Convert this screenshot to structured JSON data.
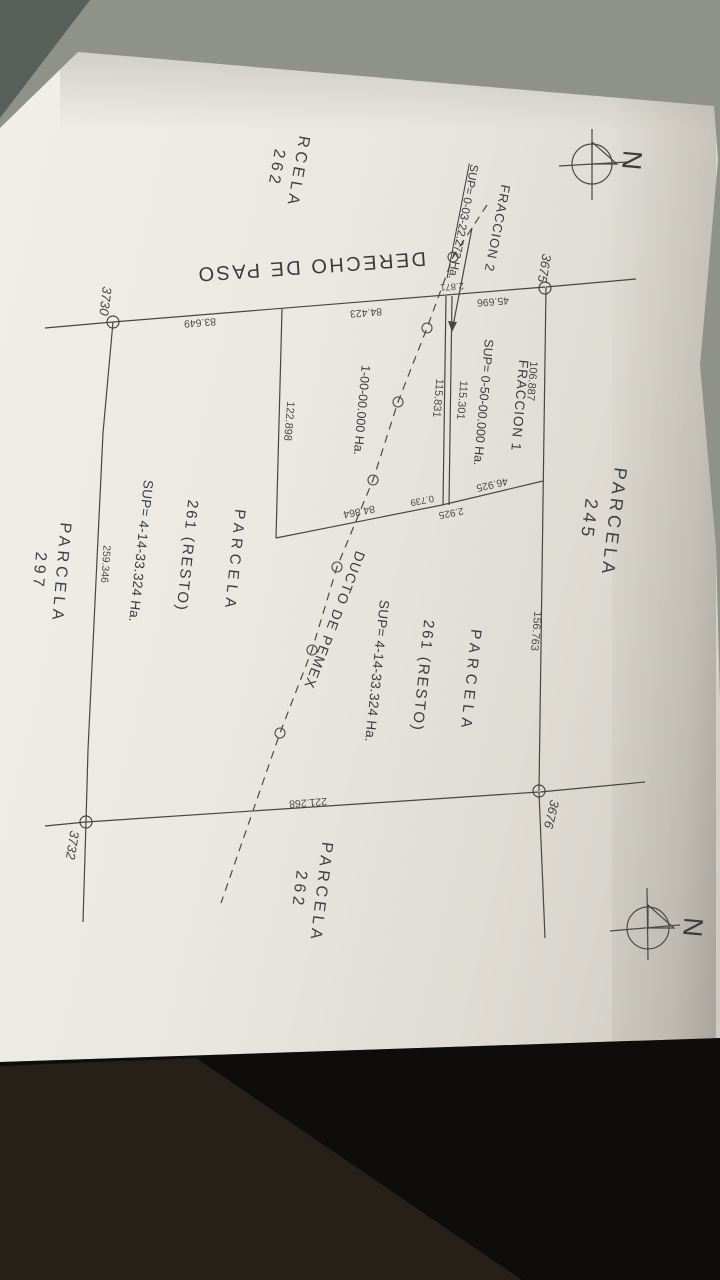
{
  "scene": {
    "description": "Photograph of a cadastral survey plan on a dark table"
  },
  "compass": {
    "north_label": "N"
  },
  "parcels": {
    "parcela_245": "PARCELA\n245",
    "parcela_262_top": "RCELA\n262",
    "parcela_262_bottom": "PARCELA\n262",
    "parcela_297": "PARCELA\n297",
    "parcela_261_left": {
      "title": "PARCELA",
      "subtitle": "261 (RESTO)",
      "sup": "SUP= 4-14-33.324 Ha."
    },
    "parcela_261_right": {
      "title": "PARCELA",
      "subtitle": "261 (RESTO)",
      "sup": "SUP= 4-14-33.324 Ha."
    },
    "fraccion_1": {
      "title": "FRACCION 1",
      "sup": "SUP= 0-50-00.000 Ha."
    },
    "fraccion_2": {
      "title": "FRACCION 2",
      "sup": "SUP= 0-03-22.272 Ha."
    }
  },
  "features": {
    "derecho_de_paso": "DERECHO DE PASO",
    "ducto_de_pemex": "DUCTO DE PEMEX",
    "pipeline_area": "1-00-00.000 Ha."
  },
  "stations": {
    "ne": "3675",
    "se": "3676",
    "nw": "3730",
    "sw": "3732"
  },
  "dimensions": {
    "north_segment_right": "106.887",
    "east_boundary": "156.763",
    "strip_west": "115.831",
    "strip_east": "115.301",
    "west_fraction_side": "122.898",
    "west_boundary": "259.346",
    "north_segment_left": "83.649",
    "north_segment_mid": "84.423",
    "north_segment_frac1": "45.696",
    "strip_width": "2.871",
    "south_frac1": "46.925",
    "strip_south_width_a": "0.739",
    "strip_south_width_b": "2.925",
    "south_diag_west": "84.864",
    "south_boundary": "221.268"
  },
  "colors": {
    "paper": "#e9e7e1",
    "ink": "#3f3f3b",
    "table_gray": "#8f9289",
    "table_dark": "#0f0d0b"
  }
}
